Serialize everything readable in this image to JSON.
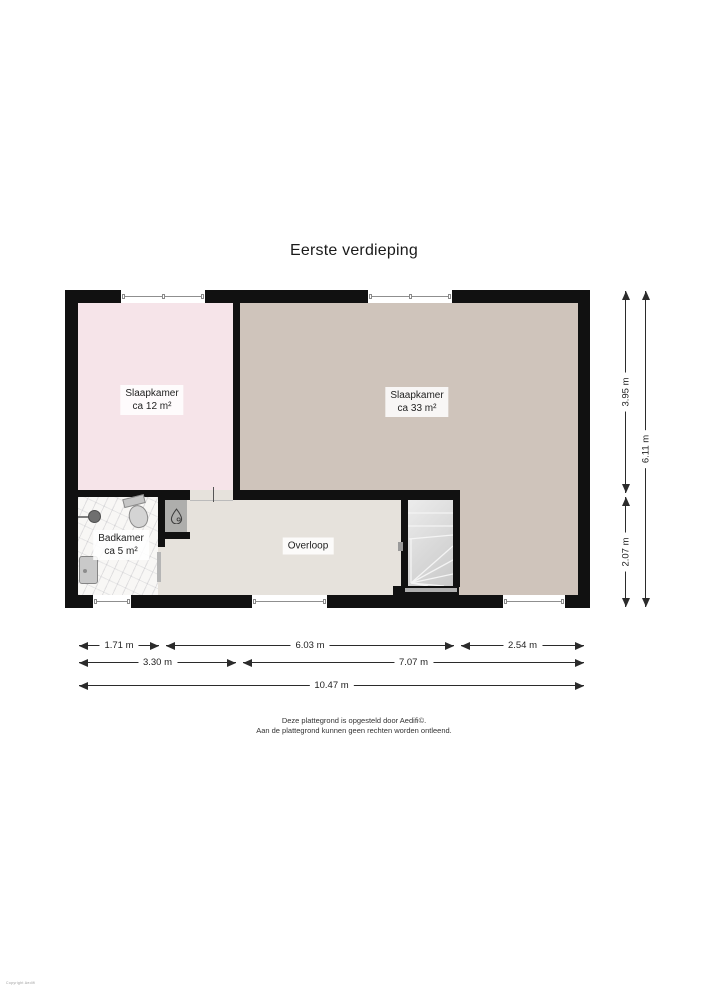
{
  "title": "Eerste verdieping",
  "rooms": [
    {
      "id": "bedroom1",
      "name": "Slaapkamer",
      "area": "ca 12 m²"
    },
    {
      "id": "bedroom2",
      "name": "Slaapkamer",
      "area": "ca 33 m²"
    },
    {
      "id": "bathroom",
      "name": "Badkamer",
      "area": "ca 5 m²"
    },
    {
      "id": "landing",
      "name": "Overloop",
      "area": ""
    }
  ],
  "dimensions": {
    "bottom": [
      "1.71 m",
      "6.03 m",
      "2.54 m",
      "3.30 m",
      "7.07 m",
      "10.47 m"
    ],
    "right": [
      "3.95 m",
      "2.07 m",
      "6.11 m"
    ]
  },
  "footer": {
    "line1": "Deze plattegrond is opgesteld door Aedifi©.",
    "line2": "Aan de plattegrond kunnen geen rechten worden ontleend."
  },
  "watermark": "Copyright Aedifi",
  "icons": {
    "boiler": "water-droplet"
  },
  "colors": {
    "wall": "#111111",
    "bedroom1_floor": "#f6e4e9",
    "bedroom2_floor": "#cfc4bb",
    "landing_floor": "#e6e2dc",
    "bathroom_floor": "#f8f7f5",
    "closet_floor": "#aeaeac",
    "stair_floor": "#d9d9d9"
  }
}
